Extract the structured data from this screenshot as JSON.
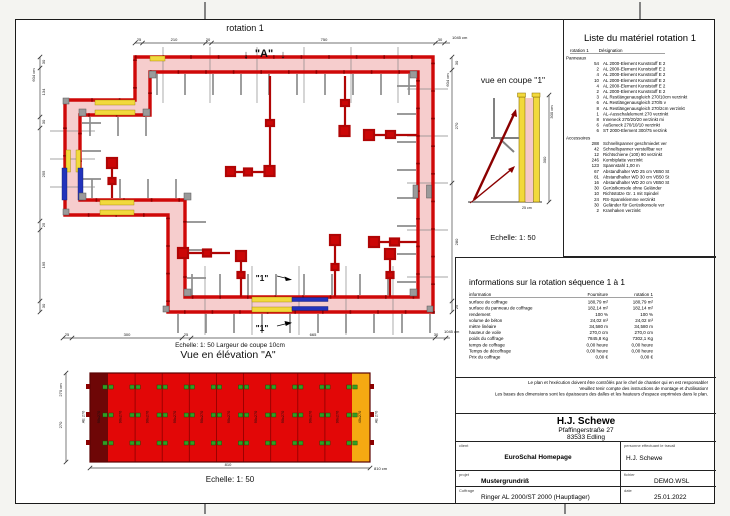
{
  "colors": {
    "wall_red": "#cf0808",
    "wall_dark": "#8f0000",
    "concrete_pink": "#f6cdcd",
    "yellow": "#f2d93c",
    "blue": "#2233bb",
    "gray": "#9a9a9a",
    "elev_red": "#e20707",
    "elev_darkred": "#6e0606",
    "elev_orange": "#f5a912",
    "clamp_green": "#2f9e23"
  },
  "plan": {
    "title": "rotation 1",
    "arrow_down": "↓",
    "section_marker": "\"A\"",
    "cut_marker": "\"1\"",
    "dims_top": [
      "25",
      "210",
      "20",
      "750",
      "30"
    ],
    "dims_top_total": "1045 cm",
    "dims_bottom": [
      "25",
      "300",
      "25",
      "665",
      "30"
    ],
    "dims_bottom_total": "1045 cm",
    "dims_left": [
      "30",
      "134",
      "30",
      "255",
      "25",
      "195",
      "30"
    ],
    "dims_left_total": "604 cm",
    "dims_right": [
      "30",
      "270",
      "280",
      "25"
    ],
    "dims_right_total": "604 cm"
  },
  "coupe": {
    "title": "vue en coupe \"1\"",
    "scale": "Echelle: 1: 50",
    "dim_total": "300 cm",
    "dim_segment": "300",
    "base_label": "25 cm"
  },
  "elevation": {
    "pretitle": "Echelle: 1: 50   Largeur de coupe 10cm",
    "title": "Vue en élévation \"A\"",
    "scale": "Echelle: 1: 50",
    "panel_label": "90x270",
    "dark_panel_label": "90x270",
    "end_panel_label": "40x270",
    "left_label": "AE 270",
    "right_label": "AE 270",
    "dim_left_total": "270 cm",
    "dim_left": "270",
    "dim_bottom": "810",
    "dim_bottom_total": "810 cm"
  },
  "materials": {
    "title": "Liste du matériel  rotation 1",
    "col_qty": "rotation 1",
    "col_des": "Désignation",
    "group_panels": "Panneaux",
    "group_accessories": "Accessoires",
    "panneaux": [
      {
        "qty": "54",
        "name": "AL 2000-Element Kunststoff E 2"
      },
      {
        "qty": "2",
        "name": "AL 2000-Element Kunststoff E 2"
      },
      {
        "qty": "4",
        "name": "AL 2000-Element Kunststoff E 2"
      },
      {
        "qty": "10",
        "name": "AL 2000-Element Kunststoff E 2"
      },
      {
        "qty": "4",
        "name": "AL 2000-Element Kunststoff E 2"
      },
      {
        "qty": "2",
        "name": "AL 2000-Element Kunststoff E 2"
      },
      {
        "qty": "3",
        "name": "AL Restlängenausgleich 270/10cm verzinkt"
      },
      {
        "qty": "6",
        "name": "AL Restlängenausgleich 270/5 v"
      },
      {
        "qty": "8",
        "name": "AL Restlängenausgleich 270/2cm verzinkt"
      },
      {
        "qty": "1",
        "name": "AL-Ausschalelement 270 verzinkt"
      },
      {
        "qty": "8",
        "name": "Inneneck 270/20/20 verzinkt mi"
      },
      {
        "qty": "6",
        "name": "Außeneck 270/10/10 verzinkt"
      },
      {
        "qty": "6",
        "name": "ST 2000-Element 300/75 verzink"
      }
    ],
    "accessoires": [
      {
        "qty": "288",
        "name": "Schnellspanner geschmiedet ver"
      },
      {
        "qty": "42",
        "name": "Schnellspanner verstellbar ver"
      },
      {
        "qty": "12",
        "name": "Richtschiene (100) 90 verzinkt"
      },
      {
        "qty": "246",
        "name": "Kombiplatte verzinkt"
      },
      {
        "qty": "123",
        "name": "Spannstahl 1,00 m"
      },
      {
        "qty": "67",
        "name": "Abstandhalter WD 25 cm VB50 St"
      },
      {
        "qty": "81",
        "name": "Abstandhalter WD 30 cm VB50 St"
      },
      {
        "qty": "16",
        "name": "Abstandhalter WD 20 cm VB50 St"
      },
      {
        "qty": "30",
        "name": "Gerüstkonsole ohne Geländer"
      },
      {
        "qty": "10",
        "name": "Richtstütze Gr. 1 mit Spindel"
      },
      {
        "qty": "24",
        "name": "RS-Spannklemme verzinkt"
      },
      {
        "qty": "30",
        "name": "Geländer für Gerüstkonsole ver"
      },
      {
        "qty": "2",
        "name": "Kranhaken verzinkt"
      }
    ]
  },
  "infos": {
    "title": "informations sur la rotation  séquence 1 à 1",
    "col_info": "information",
    "col_fourniture": "Fourniture",
    "col_rotation": "rotation 1",
    "rows": [
      {
        "label": "surface de coffrage",
        "v1": "180,79 m²",
        "v2": "180,79 m²"
      },
      {
        "label": "surface du panneau de coffrage",
        "v1": "182,14 m²",
        "v2": "182,14 m²"
      },
      {
        "label": "rendement",
        "v1": "100 %",
        "v2": "100 %"
      },
      {
        "label": "volume de béton",
        "v1": "24,02 m³",
        "v2": "24,02 m³"
      },
      {
        "label": "mètre linéaire",
        "v1": "34,580 m",
        "v2": "34,580 m"
      },
      {
        "label": "hauteur de voile",
        "v1": "270,0 cm",
        "v2": "270,0 cm"
      },
      {
        "label": "poids du coffrage",
        "v1": "7845,8 Kg",
        "v2": "7302,1 Kg"
      },
      {
        "label": "temps de coffrage",
        "v1": "0,00 heure",
        "v2": "0,00 heure"
      },
      {
        "label": "Temps de décoffrage",
        "v1": "0,00 heure",
        "v2": "0,00 heure"
      },
      {
        "label": "Prix du coffrage",
        "v1": "0,00 €",
        "v2": "0,00 €"
      }
    ]
  },
  "disclaimer": {
    "line1": "Le plan et l'exécution doivent être contrôlés par le chef de chantier qui en est responsable!",
    "line2": "Veuillez tenir compte des instructions de montage et d'utilisation!",
    "line3": "Les bases des dimensions sont les épaisseurs des dalles et les hauteurs d'espace exprimées dans le plan."
  },
  "titleblock": {
    "company": "H.J. Schewe",
    "address1": "Pfaffingerstraße 27",
    "address2": "83533 Edling",
    "client_label": "client",
    "client": "EuroSchal Homepage",
    "worker_label": "personne effectuant le travail",
    "worker": "H.J. Schewe",
    "project_label": "projet",
    "project": "Mustergrundriß",
    "file_label": "fichier",
    "file": "DEMO.WSL",
    "formwork_label": "Coffrage",
    "formwork": "Ringer AL 2000/ST 2000 (Hauptlager)",
    "date_label": "date",
    "date": "25.01.2022"
  }
}
